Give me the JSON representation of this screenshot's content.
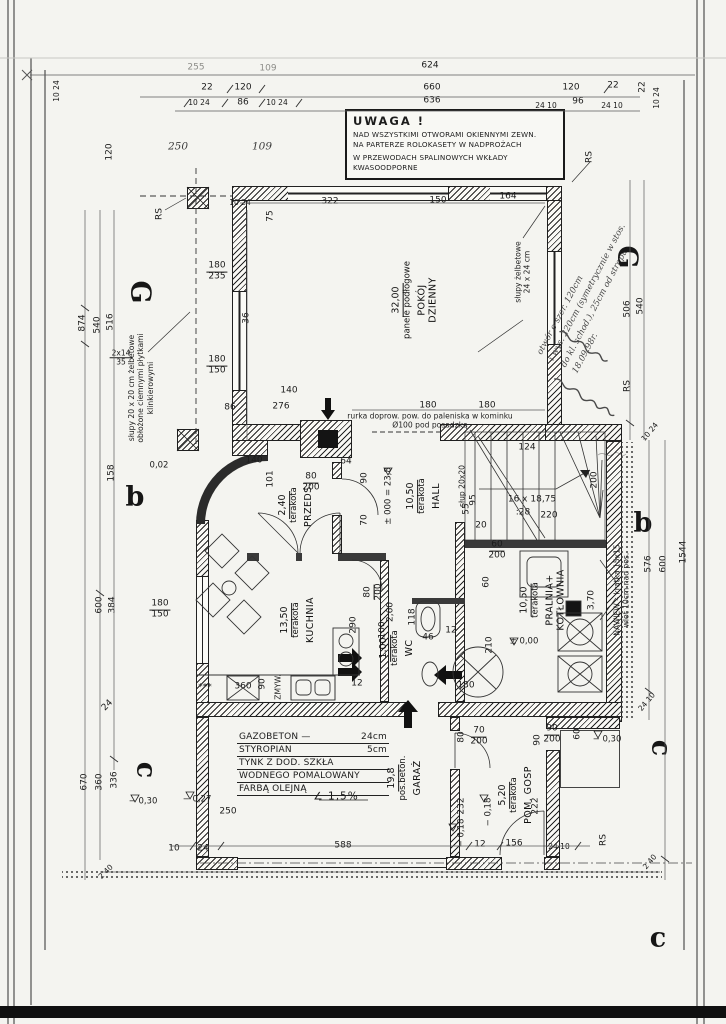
{
  "uwaga": {
    "title": "UWAGA !",
    "lines": [
      "NAD WSZYSTKIMI OTWORAMI OKIENNYMI ZEWN.",
      "NA PARTERZE ROLOKASETY W NADPROŻACH",
      "W PRZEWODACH SPALINOWYCH WKŁADY",
      "KWASOODPORNE"
    ]
  },
  "materials_note": {
    "rows": [
      {
        "l": "GAZOBETON —",
        "v": "24cm"
      },
      {
        "l": "STYROPIAN",
        "v": "5cm"
      },
      {
        "l": "TYNK Z DOD. SZKŁA",
        "v": ""
      },
      {
        "l": "WODNEGO POMALOWANY",
        "v": ""
      },
      {
        "l": "FARBĄ OLEJNĄ",
        "v": ""
      }
    ],
    "slope": "∠ 1,5%"
  },
  "rooms": [
    {
      "name": "POKÓJ\nDZIENNY",
      "area": "32,00",
      "floor": "panele podłogowe",
      "x": 415,
      "y": 300
    },
    {
      "name": "HALL",
      "area": "10,50",
      "floor": "terakota",
      "x": 424,
      "y": 496
    },
    {
      "name": "PRZEDS.",
      "area": "2,40",
      "floor": "terakota",
      "x": 296,
      "y": 505
    },
    {
      "name": "KUCHNIA",
      "area": "13,50",
      "floor": "terakota",
      "x": 298,
      "y": 620
    },
    {
      "name": "WC",
      "area": "1,00",
      "floor": "terakota",
      "x": 397,
      "y": 648
    },
    {
      "name": "PRALNIA+\nKOTŁOWNIA",
      "area": "10,50",
      "floor": "terakota",
      "x": 543,
      "y": 600
    },
    {
      "name": "GARAŻ",
      "area": "19,8",
      "floor": "pos.beton.",
      "x": 405,
      "y": 778
    },
    {
      "name": "POM. GOSP",
      "area": "5,20",
      "floor": "terakota",
      "x": 516,
      "y": 795
    }
  ],
  "annotations": [
    {
      "lines": [
        "słupy żelbetowe",
        "24 x 24 cm"
      ],
      "x": 523,
      "y": 272,
      "r": -90
    },
    {
      "lines": [
        "słupy 20 x 20 cm żelbetowe",
        "obłożone ciemnymi płytkami",
        "klinkierowymi"
      ],
      "x": 141,
      "y": 388,
      "r": -90
    },
    {
      "lines": [
        "NAWIEW – kratka 15x15",
        "wlot 10cm nad pos."
      ],
      "x": 622,
      "y": 590,
      "r": -90
    },
    {
      "lines": [
        "rurka doprow. pow. do paleniska w kominku",
        "Ø100 pod posadzką"
      ],
      "x": 430,
      "y": 421,
      "r": 0
    },
    {
      "lines": [
        "słup 20x20"
      ],
      "x": 462,
      "y": 486,
      "r": -90
    },
    {
      "lines": [
        "ZMYW."
      ],
      "x": 278,
      "y": 687,
      "r": -90
    }
  ],
  "handwriting": {
    "lines": [
      "otwór o szer. 120cm",
      "i wys. 220cm (symetrycznie w stos.",
      "do kl. schod.), 25cm od stropu.",
      "18.09.98r."
    ],
    "x": 594,
    "y": 296,
    "r": -62
  },
  "section_marks": [
    {
      "g": "G",
      "x": 140,
      "y": 292,
      "r": 90
    },
    {
      "g": "G",
      "x": 627,
      "y": 257,
      "r": 90
    },
    {
      "g": "b",
      "x": 135,
      "y": 497,
      "r": 0
    },
    {
      "g": "b",
      "x": 643,
      "y": 523,
      "r": 0
    },
    {
      "g": "c",
      "x": 146,
      "y": 770,
      "r": 90
    },
    {
      "g": "c",
      "x": 661,
      "y": 748,
      "r": 90
    },
    {
      "g": "c",
      "x": 658,
      "y": 938,
      "r": 0
    }
  ],
  "dim_labels": [
    {
      "t": "255",
      "x": 196,
      "y": 68,
      "c": "faint"
    },
    {
      "t": "109",
      "x": 268,
      "y": 69,
      "c": "faint"
    },
    {
      "t": "624",
      "x": 430,
      "y": 66
    },
    {
      "t": "22",
      "x": 207,
      "y": 88
    },
    {
      "t": "120",
      "x": 243,
      "y": 88
    },
    {
      "t": "660",
      "x": 432,
      "y": 88
    },
    {
      "t": "120",
      "x": 571,
      "y": 88
    },
    {
      "t": "22",
      "x": 613,
      "y": 86
    },
    {
      "t": "10 24",
      "x": 199,
      "y": 103,
      "c": "f"
    },
    {
      "t": "86",
      "x": 243,
      "y": 103
    },
    {
      "t": "10 24",
      "x": 277,
      "y": 103,
      "c": "f"
    },
    {
      "t": "636",
      "x": 432,
      "y": 101
    },
    {
      "t": "24 10",
      "x": 546,
      "y": 106,
      "c": "f"
    },
    {
      "t": "96",
      "x": 578,
      "y": 102
    },
    {
      "t": "24 10",
      "x": 612,
      "y": 106,
      "c": "f"
    },
    {
      "t": "250",
      "x": 178,
      "y": 147,
      "c": "hw"
    },
    {
      "t": "109",
      "x": 262,
      "y": 147,
      "c": "hw"
    },
    {
      "t": "RS",
      "x": 160,
      "y": 214,
      "r": -90
    },
    {
      "t": "120",
      "x": 110,
      "y": 152,
      "r": -90
    },
    {
      "t": "10 24",
      "x": 57,
      "y": 91,
      "r": -90,
      "c": "f"
    },
    {
      "t": "22",
      "x": 643,
      "y": 87,
      "r": -90
    },
    {
      "t": "10 24",
      "x": 657,
      "y": 98,
      "r": -90,
      "c": "f"
    },
    {
      "t": "75",
      "x": 271,
      "y": 216,
      "r": -90
    },
    {
      "t": "10 24",
      "x": 240,
      "y": 203,
      "c": "f"
    },
    {
      "t": "322",
      "x": 330,
      "y": 202
    },
    {
      "t": "150",
      "x": 438,
      "y": 201
    },
    {
      "t": "164",
      "x": 508,
      "y": 197
    },
    {
      "t": "180|235",
      "x": 217,
      "y": 272
    },
    {
      "t": "36",
      "x": 247,
      "y": 318,
      "r": -90
    },
    {
      "t": "180|150",
      "x": 217,
      "y": 366
    },
    {
      "t": "86",
      "x": 230,
      "y": 408
    },
    {
      "t": "140",
      "x": 289,
      "y": 391
    },
    {
      "t": "276",
      "x": 281,
      "y": 407
    },
    {
      "t": "180",
      "x": 428,
      "y": 406
    },
    {
      "t": "180",
      "x": 487,
      "y": 406
    },
    {
      "t": "64",
      "x": 346,
      "y": 462
    },
    {
      "t": "80|200",
      "x": 311,
      "y": 483
    },
    {
      "t": "101",
      "x": 271,
      "y": 479,
      "r": -90
    },
    {
      "t": "140",
      "x": 254,
      "y": 461
    },
    {
      "t": "0,02",
      "x": 159,
      "y": 466,
      "c": "lvl"
    },
    {
      "t": "90",
      "x": 365,
      "y": 478,
      "r": -90
    },
    {
      "t": "70",
      "x": 365,
      "y": 520,
      "r": -90
    },
    {
      "t": "95",
      "x": 474,
      "y": 500,
      "r": -90
    },
    {
      "t": "124",
      "x": 527,
      "y": 448
    },
    {
      "t": "200",
      "x": 595,
      "y": 480,
      "r": -90
    },
    {
      "t": "220",
      "x": 549,
      "y": 516
    },
    {
      "t": "16 x 18,75",
      "x": 532,
      "y": 500
    },
    {
      "t": ":28",
      "x": 523,
      "y": 513
    },
    {
      "t": "20",
      "x": 481,
      "y": 526
    },
    {
      "t": "55",
      "x": 467,
      "y": 509,
      "r": -90
    },
    {
      "t": "± 000 = 23,8",
      "x": 389,
      "y": 496,
      "r": -90,
      "c": "lvl"
    },
    {
      "t": "540",
      "x": 641,
      "y": 306,
      "r": -90
    },
    {
      "t": "506",
      "x": 628,
      "y": 309,
      "r": -90
    },
    {
      "t": "RS",
      "x": 590,
      "y": 157,
      "r": -90
    },
    {
      "t": "RS",
      "x": 628,
      "y": 386,
      "r": -90
    },
    {
      "t": "1544",
      "x": 684,
      "y": 552,
      "r": -90
    },
    {
      "t": "600",
      "x": 664,
      "y": 564,
      "r": -90
    },
    {
      "t": "576",
      "x": 649,
      "y": 564,
      "r": -90
    },
    {
      "t": "10 24",
      "x": 650,
      "y": 432,
      "r": -50,
      "c": "f"
    },
    {
      "t": "24 10",
      "x": 647,
      "y": 702,
      "r": -50,
      "c": "f"
    },
    {
      "t": "290",
      "x": 354,
      "y": 625,
      "r": -90
    },
    {
      "t": "80|200",
      "x": 374,
      "y": 592,
      "r": -90
    },
    {
      "t": "2,60",
      "x": 391,
      "y": 612,
      "r": -90
    },
    {
      "t": "100",
      "x": 383,
      "y": 630,
      "r": -90
    },
    {
      "t": "118",
      "x": 413,
      "y": 617,
      "r": -90
    },
    {
      "t": "46",
      "x": 428,
      "y": 638
    },
    {
      "t": "12",
      "x": 451,
      "y": 631
    },
    {
      "t": "210",
      "x": 490,
      "y": 645,
      "r": -90
    },
    {
      "t": "60",
      "x": 487,
      "y": 582,
      "r": -90
    },
    {
      "t": "130",
      "x": 466,
      "y": 686
    },
    {
      "t": "***",
      "x": 205,
      "y": 688
    },
    {
      "t": "360",
      "x": 243,
      "y": 687
    },
    {
      "t": "90",
      "x": 263,
      "y": 684,
      "r": -90
    },
    {
      "t": "12",
      "x": 357,
      "y": 684
    },
    {
      "t": "± 0,00",
      "x": 524,
      "y": 642,
      "c": "lvl"
    },
    {
      "t": "3,70",
      "x": 592,
      "y": 600,
      "r": -90
    },
    {
      "t": "60|200",
      "x": 497,
      "y": 551
    },
    {
      "t": "− 0,30",
      "x": 607,
      "y": 740,
      "c": "lvl"
    },
    {
      "t": "− 0,30",
      "x": 143,
      "y": 802,
      "c": "lvl"
    },
    {
      "t": "− 0,27",
      "x": 197,
      "y": 800,
      "c": "lvl"
    },
    {
      "t": "∠ 1,5%",
      "x": 336,
      "y": 797,
      "c": "slope"
    },
    {
      "t": "70|200",
      "x": 479,
      "y": 737
    },
    {
      "t": "80",
      "x": 462,
      "y": 737,
      "r": -90
    },
    {
      "t": "90",
      "x": 538,
      "y": 740,
      "r": -90
    },
    {
      "t": "90|200",
      "x": 552,
      "y": 735
    },
    {
      "t": "60",
      "x": 578,
      "y": 734,
      "r": -90
    },
    {
      "t": "232",
      "x": 462,
      "y": 806,
      "r": -90
    },
    {
      "t": "222",
      "x": 536,
      "y": 806,
      "r": -90
    },
    {
      "t": "− 0,18",
      "x": 489,
      "y": 812,
      "r": -90,
      "c": "lvl"
    },
    {
      "t": "− 0,18",
      "x": 462,
      "y": 833,
      "r": -90,
      "c": "lvl"
    },
    {
      "t": "250",
      "x": 228,
      "y": 812
    },
    {
      "t": "670",
      "x": 85,
      "y": 782,
      "r": -90
    },
    {
      "t": "360",
      "x": 100,
      "y": 782,
      "r": -90
    },
    {
      "t": "336",
      "x": 115,
      "y": 780,
      "r": -90
    },
    {
      "t": "874",
      "x": 83,
      "y": 323,
      "r": -90
    },
    {
      "t": "540",
      "x": 98,
      "y": 325,
      "r": -90
    },
    {
      "t": "516",
      "x": 111,
      "y": 322,
      "r": -90
    },
    {
      "t": "2x14|35",
      "x": 121,
      "y": 358,
      "c": "f"
    },
    {
      "t": "600",
      "x": 100,
      "y": 605,
      "r": -90
    },
    {
      "t": "384",
      "x": 113,
      "y": 605,
      "r": -90
    },
    {
      "t": "158",
      "x": 112,
      "y": 473,
      "r": -90
    },
    {
      "t": "180|150",
      "x": 160,
      "y": 610
    },
    {
      "t": "588",
      "x": 343,
      "y": 846
    },
    {
      "t": "12",
      "x": 480,
      "y": 845
    },
    {
      "t": "156",
      "x": 514,
      "y": 844
    },
    {
      "t": "24 10",
      "x": 559,
      "y": 847,
      "c": "f"
    },
    {
      "t": "10",
      "x": 174,
      "y": 849
    },
    {
      "t": "24",
      "x": 203,
      "y": 849
    },
    {
      "t": "24",
      "x": 108,
      "y": 706,
      "r": -45
    },
    {
      "t": "2 40",
      "x": 106,
      "y": 872,
      "r": -45,
      "c": "f"
    },
    {
      "t": "2 40",
      "x": 650,
      "y": 862,
      "r": -50,
      "c": "f"
    },
    {
      "t": "RS",
      "x": 604,
      "y": 840,
      "r": -90
    }
  ]
}
